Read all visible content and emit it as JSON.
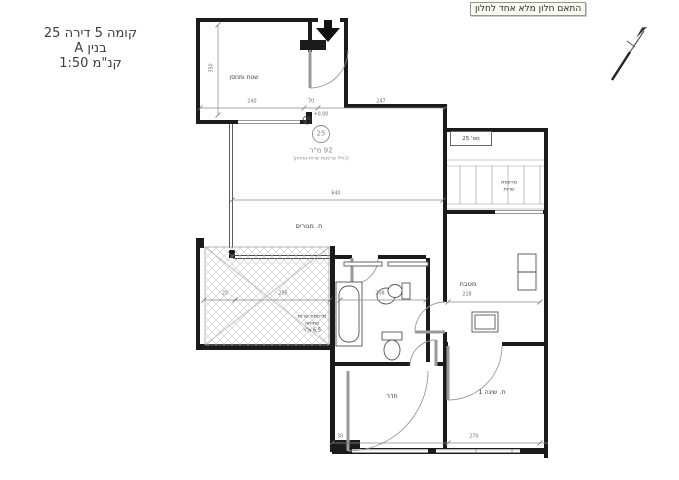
{
  "colors": {
    "ink": "#1b1b1b",
    "dim_line": "#8a8a8a",
    "label": "#3d3d3d",
    "dim_text": "#6e6e6e",
    "note_bg": "#fbfaf0",
    "note_border": "#97978b"
  },
  "title_block": {
    "line1": "קומה 5 דירה 25",
    "line2": "בנין A",
    "line3": "קנ\"מ 1:50"
  },
  "note": "התאם חלון מלא אחד לחלון",
  "plan": {
    "unit_circle": "25",
    "unit_box": "מס' 25",
    "area": "92 מ\"ר",
    "area_note": "(כולל מרפסת שרות ומחסן)",
    "level": "+0.00",
    "rooms": {
      "storage": "שטח ומחסן",
      "living": "ח. מגורים",
      "kitchen": "מטבח",
      "room": "חדר",
      "bedroom": "ח. שינה 1",
      "open_balcony": [
        "מרפסת שרות",
        "פתוחה",
        "6.5 מ\"ר"
      ],
      "service_balcony": [
        "מרפסת",
        "שרות"
      ]
    },
    "dimensions": [
      "240",
      "70",
      "247",
      "350",
      "640",
      "25",
      "205",
      "208",
      "218",
      "30",
      "270"
    ]
  }
}
